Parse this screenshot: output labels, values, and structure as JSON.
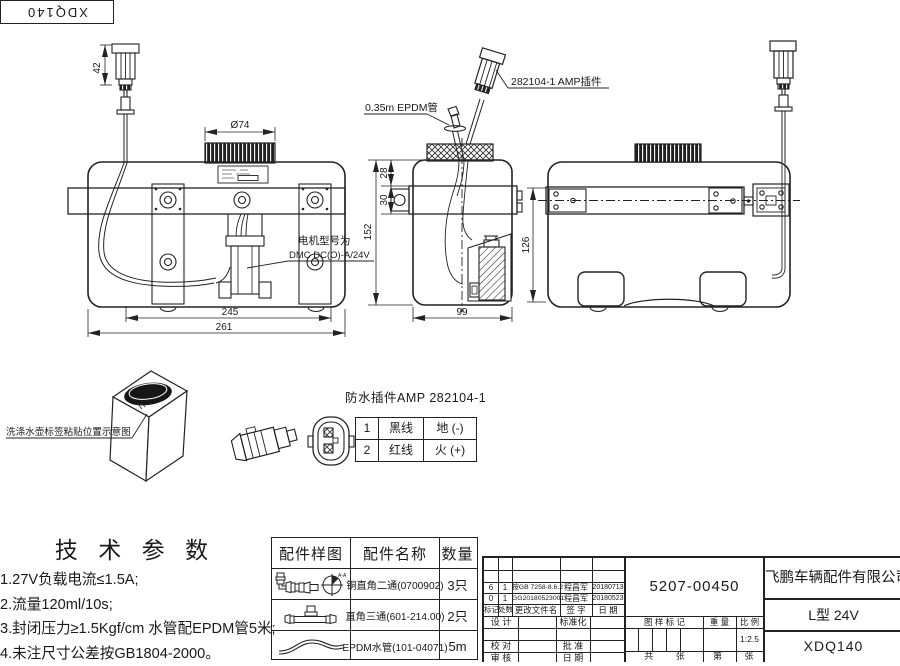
{
  "corner": {
    "code": "XDQ140"
  },
  "drawing": {
    "dims": {
      "d42": "42",
      "d74": "Ø74",
      "d245": "245",
      "d261": "261",
      "d28": "28",
      "d30": "30",
      "d152": "152",
      "d99": "99",
      "d126": "126"
    },
    "labels": {
      "amp_connector": "282104-1  AMP插件",
      "epdm_tube": "0.35m EPDM管",
      "motor_line1": "电机型号为",
      "motor_line2": "DMC DC(O)-A/24V",
      "bottle_note": "洗涤水壶标签粘贴位置示意图"
    },
    "connector_detail": {
      "title": "防水插件AMP 282104-1",
      "pins": [
        {
          "no": "1",
          "wire": "黑线",
          "function": "地 (-)"
        },
        {
          "no": "2",
          "wire": "红线",
          "function": "火 (+)"
        }
      ]
    }
  },
  "tech_params": {
    "title": "技 术 参 数",
    "items": [
      "1.27V负载电流≤1.5A;",
      "2.流量120ml/10s;",
      "3.封闭压力≥1.5Kgf/cm 水管配EPDM管5米;",
      "4.未注尺寸公差按GB1804-2000。"
    ]
  },
  "parts_table": {
    "headers": [
      "配件样图",
      "配件名称",
      "数量"
    ],
    "rows": [
      {
        "icon": "elbow-fitting",
        "view_mark": "A-A",
        "name": "铜直角二通(0700902)",
        "qty": "3只"
      },
      {
        "icon": "tee-fitting",
        "view_mark": "",
        "name": "直角三通(601-214.00)",
        "qty": "2只"
      },
      {
        "icon": "epdm-hose",
        "view_mark": "",
        "name": "EPDM水管(101-04071)",
        "qty": "5m"
      }
    ]
  },
  "title_block": {
    "part_number": "5207-00450",
    "company": "飞鹏车辆配件有限公司",
    "model": "L型 24V",
    "drawing_number": "XDQ140",
    "scale_value": "1:2.5",
    "rev_header": {
      "mark": "标记",
      "count": "处数",
      "doc": "更改文件名",
      "sign": "签 字",
      "date": "日 期"
    },
    "revisions": [
      {
        "mark": "6",
        "count": "1",
        "doc": "按GB 7258-8.6.2",
        "sign": "程昌军",
        "date": "20180713"
      },
      {
        "mark": "0",
        "count": "1",
        "doc": "GG20180523001",
        "sign": "程昌军",
        "date": "20180523"
      }
    ],
    "sign_labels": {
      "design": "设 计",
      "standard": "标准化",
      "check": "校 对",
      "approve": "批 准",
      "audit": "审 核",
      "date": "日 期"
    },
    "stamp_labels": {
      "mark": "图 样 标 记",
      "weight": "重 量",
      "scale": "比 例",
      "sheet_total": "共  张",
      "sheet_no": "第  张"
    }
  }
}
